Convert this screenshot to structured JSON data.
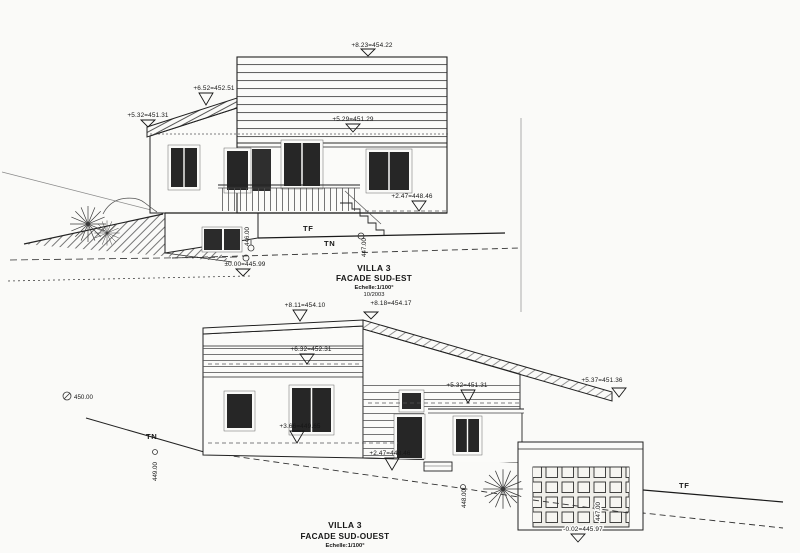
{
  "sheet": {
    "background": "#fafaf8",
    "ink": "#1f1f1f"
  },
  "se": {
    "levels": {
      "ridge": "+8.23=454.22",
      "upper_left": "+6.52=452.51",
      "eave_left": "+5.32=451.31",
      "floor": "+5.29=451.29",
      "terrace": "+2.47=448.46",
      "ground": "±0.00=445.99"
    },
    "terrain": {
      "tf": "TF",
      "tn": "TN"
    },
    "spots": {
      "s446": "446.00",
      "s447": "447.00"
    },
    "title": {
      "line1": "VILLA 3",
      "line2": "FACADE SUD-EST",
      "scale": "Echelle:1/100°",
      "date": "10/2003"
    }
  },
  "so": {
    "levels": {
      "top_left": "+8.11=454.10",
      "top_right": "+8.18=454.17",
      "band": "+6.32=452.31",
      "porch": "+5.32=451.31",
      "eave_right": "+5.37=451.36",
      "mid": "+3.66=449.65",
      "landing": "+2.47=448.46",
      "garage": "-0.02=445.97"
    },
    "terrain": {
      "tf": "TF",
      "tn": "TN"
    },
    "spots": {
      "s450": "450.00",
      "s449": "449.00",
      "s448": "448.00",
      "s447": "447.00"
    },
    "title": {
      "line1": "VILLA 3",
      "line2": "FACADE SUD-OUEST",
      "scale": "Echelle:1/100°"
    }
  }
}
